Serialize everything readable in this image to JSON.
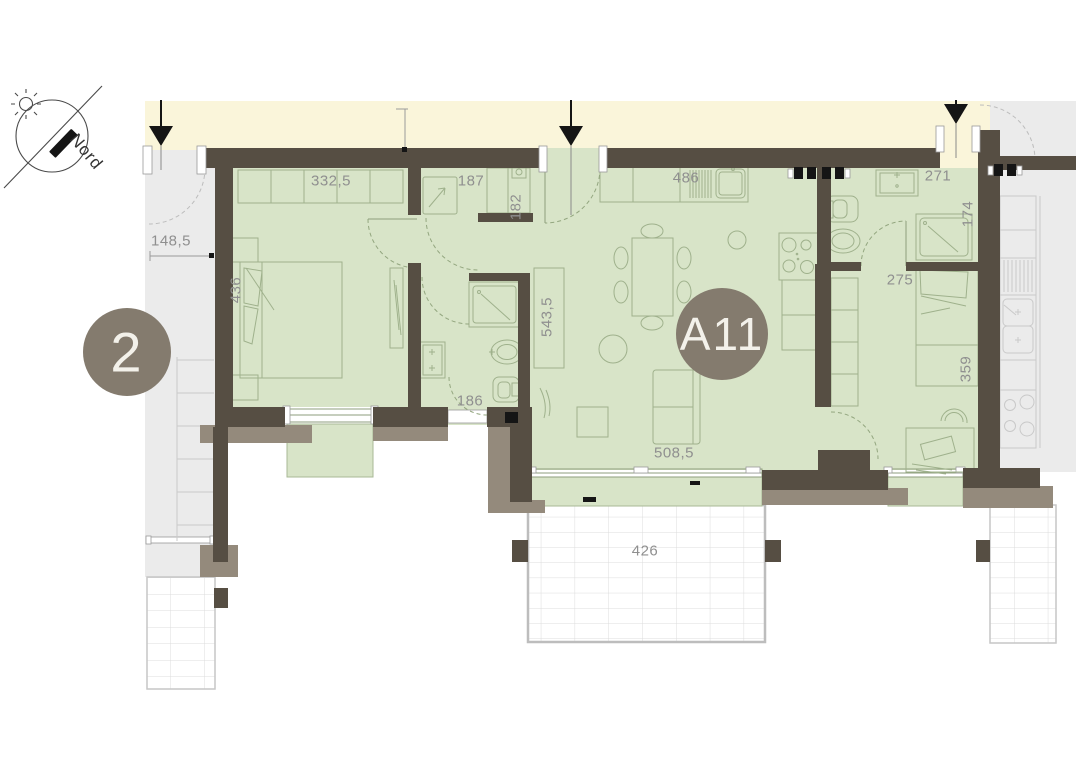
{
  "compass": {
    "label": "Nord"
  },
  "units": {
    "current": {
      "id": "A11"
    },
    "neighbor_left": {
      "id": "2"
    }
  },
  "dimensions": {
    "left_neighbor_entry": "148,5",
    "bedroom1_width": "332,5",
    "bedroom1_depth": "436",
    "storage_width": "187",
    "storage_depth": "182",
    "kitchen_living_width": "486",
    "living_depth": "543,5",
    "living_width": "508,5",
    "bathroom2_width": "186",
    "bathroom1_width": "271",
    "shower_width": "174",
    "bedroom2_hall_width": "275",
    "bedroom2_depth": "359",
    "terrace_width": "426"
  },
  "colors": {
    "room_fill": "#d8e4c8",
    "corridor_fill": "#faf5da",
    "neighbor_fill": "#ebebeb",
    "wall": "#564e43",
    "wall_outer": "#948a7c",
    "unit_badge": "#847b6e",
    "dimension_text": "#8f8f8f"
  }
}
